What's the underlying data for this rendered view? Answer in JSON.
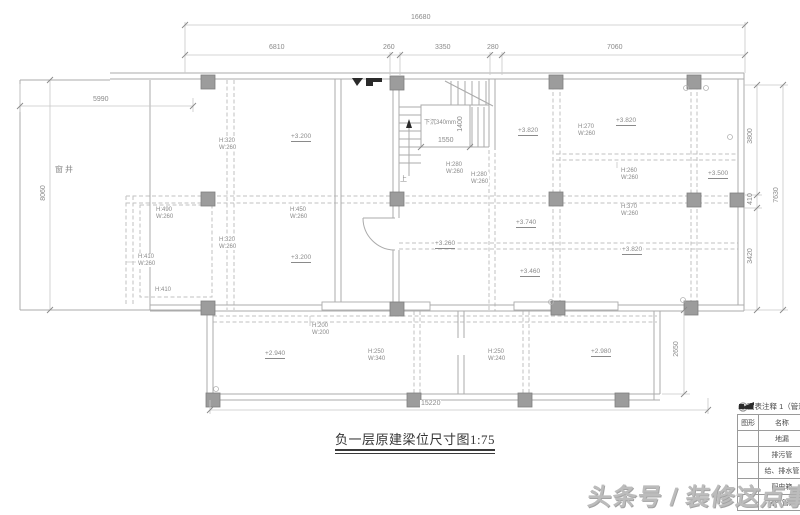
{
  "title": "负一层原建梁位尺寸图1:75",
  "watermark": "头条号 / 装修这点事",
  "plan": {
    "courtyard_label": "窗井",
    "stair": {
      "sunken": "下沉340mm",
      "up": "上",
      "width": "1550",
      "depth": "1400"
    }
  },
  "dims": {
    "top_total": "16680",
    "top_segments": [
      "6810",
      "260",
      "3350",
      "280",
      "7060"
    ],
    "left_width": "5990",
    "left_height": "8060",
    "right_segments": [
      "3800",
      "410",
      "3420"
    ],
    "right_total": "7630",
    "bottom_total": "15220",
    "lower_right_height": "2650"
  },
  "elevations": [
    {
      "text": "+3.200"
    },
    {
      "text": "+3.820"
    },
    {
      "text": "+3.820"
    },
    {
      "text": "+3.500"
    },
    {
      "text": "+3.200"
    },
    {
      "text": "+3.740"
    },
    {
      "text": "+3.820"
    },
    {
      "text": "+3.260"
    },
    {
      "text": "+3.460"
    },
    {
      "text": "+2.940"
    },
    {
      "text": "+2.980"
    }
  ],
  "beams": [
    {
      "h": "H:320",
      "w": "W:260"
    },
    {
      "h": "H:490",
      "w": "W:260"
    },
    {
      "h": "H:450",
      "w": "W:260"
    },
    {
      "h": "H:320",
      "w": "W:260"
    },
    {
      "h": "H:410",
      "w": "W:260"
    },
    {
      "h": "H:410",
      "w": ""
    },
    {
      "h": "H:280",
      "w": "W:260"
    },
    {
      "h": "H:280",
      "w": "W:260"
    },
    {
      "h": "H:270",
      "w": "W:260"
    },
    {
      "h": "H:260",
      "w": "W:260"
    },
    {
      "h": "H:370",
      "w": "W:260"
    },
    {
      "h": "H:200",
      "w": "W:200"
    },
    {
      "h": "H:250",
      "w": "W:340"
    },
    {
      "h": "H:250",
      "w": "W:240"
    }
  ],
  "legend": {
    "title": "图表注释 1（管道",
    "headers": [
      "图形",
      "名称"
    ],
    "rows": [
      {
        "name": "地漏"
      },
      {
        "name": "排污管"
      },
      {
        "name": "给、排水管"
      },
      {
        "name": "配电箱"
      },
      {
        "name": "排气管道"
      }
    ]
  },
  "colors": {
    "wall_line": "#ababab",
    "dashed_line": "#c2c2c2",
    "column_fill": "#9c9c9c",
    "annotation_text": "#8a8a8a",
    "title_text": "#353535",
    "watermark": "#bcbcbc"
  }
}
